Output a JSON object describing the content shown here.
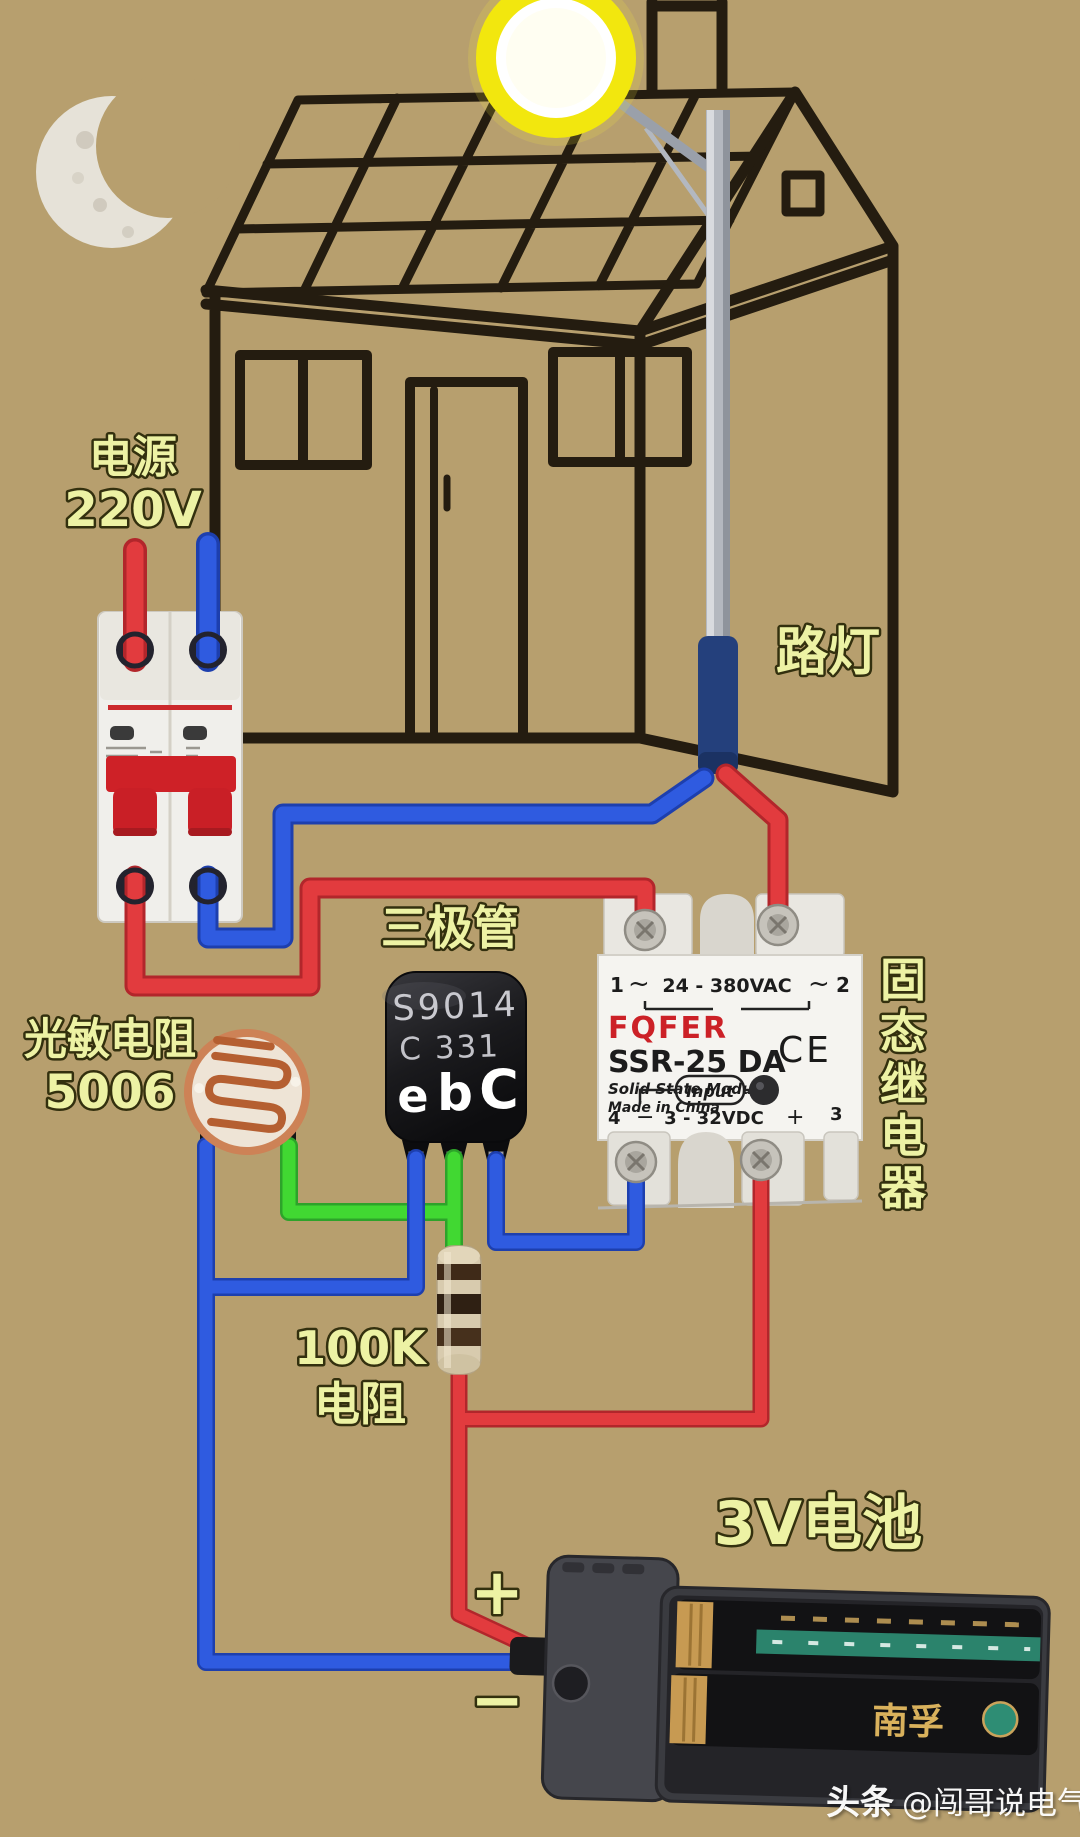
{
  "scene": {
    "background": "#b79f6e",
    "line_color": "#241c10",
    "label_color": "#edf2a4",
    "label_outline": "#33300e"
  },
  "labels": {
    "power_line1": "电源",
    "power_line2": "220V",
    "street_lamp": "路灯",
    "transistor": "三极管",
    "photoresistor_line1": "光敏电阻",
    "photoresistor_line2": "5006",
    "ssr_vertical": [
      "固",
      "态",
      "继",
      "电",
      "器"
    ],
    "resistor_line1": "100K",
    "resistor_line2": "电阻",
    "battery": "3V电池",
    "battery_plus": "+",
    "battery_minus": "−"
  },
  "transistor": {
    "part_number": "S9014",
    "date_code": "C 331",
    "pin_e": "e",
    "pin_b": "b",
    "pin_c": "C"
  },
  "ssr": {
    "brand": "FQFER",
    "model": "SSR-25 DA",
    "module_type": "Solid State Module",
    "origin": "Made in China",
    "ac_rating": "24 - 380VAC",
    "dc_rating": "3 - 32VDC",
    "input_label": "Input",
    "ce_mark": "CE",
    "terminal_1": "1",
    "terminal_2": "2",
    "terminal_3": "3",
    "terminal_4": "4",
    "tilde_left": "~",
    "tilde_right": "~",
    "dc_minus": "−",
    "dc_plus": "+"
  },
  "battery": {
    "brand": "南孚"
  },
  "watermark": {
    "prefix": "头条",
    "handle": "@闯哥说电气"
  },
  "wires": {
    "live": "#e23b3e",
    "live_dark": "#b2262b",
    "neutral": "#2f5be0",
    "neutral_dark": "#1d3fae",
    "signal": "#41d832",
    "signal_dark": "#2da32a"
  }
}
